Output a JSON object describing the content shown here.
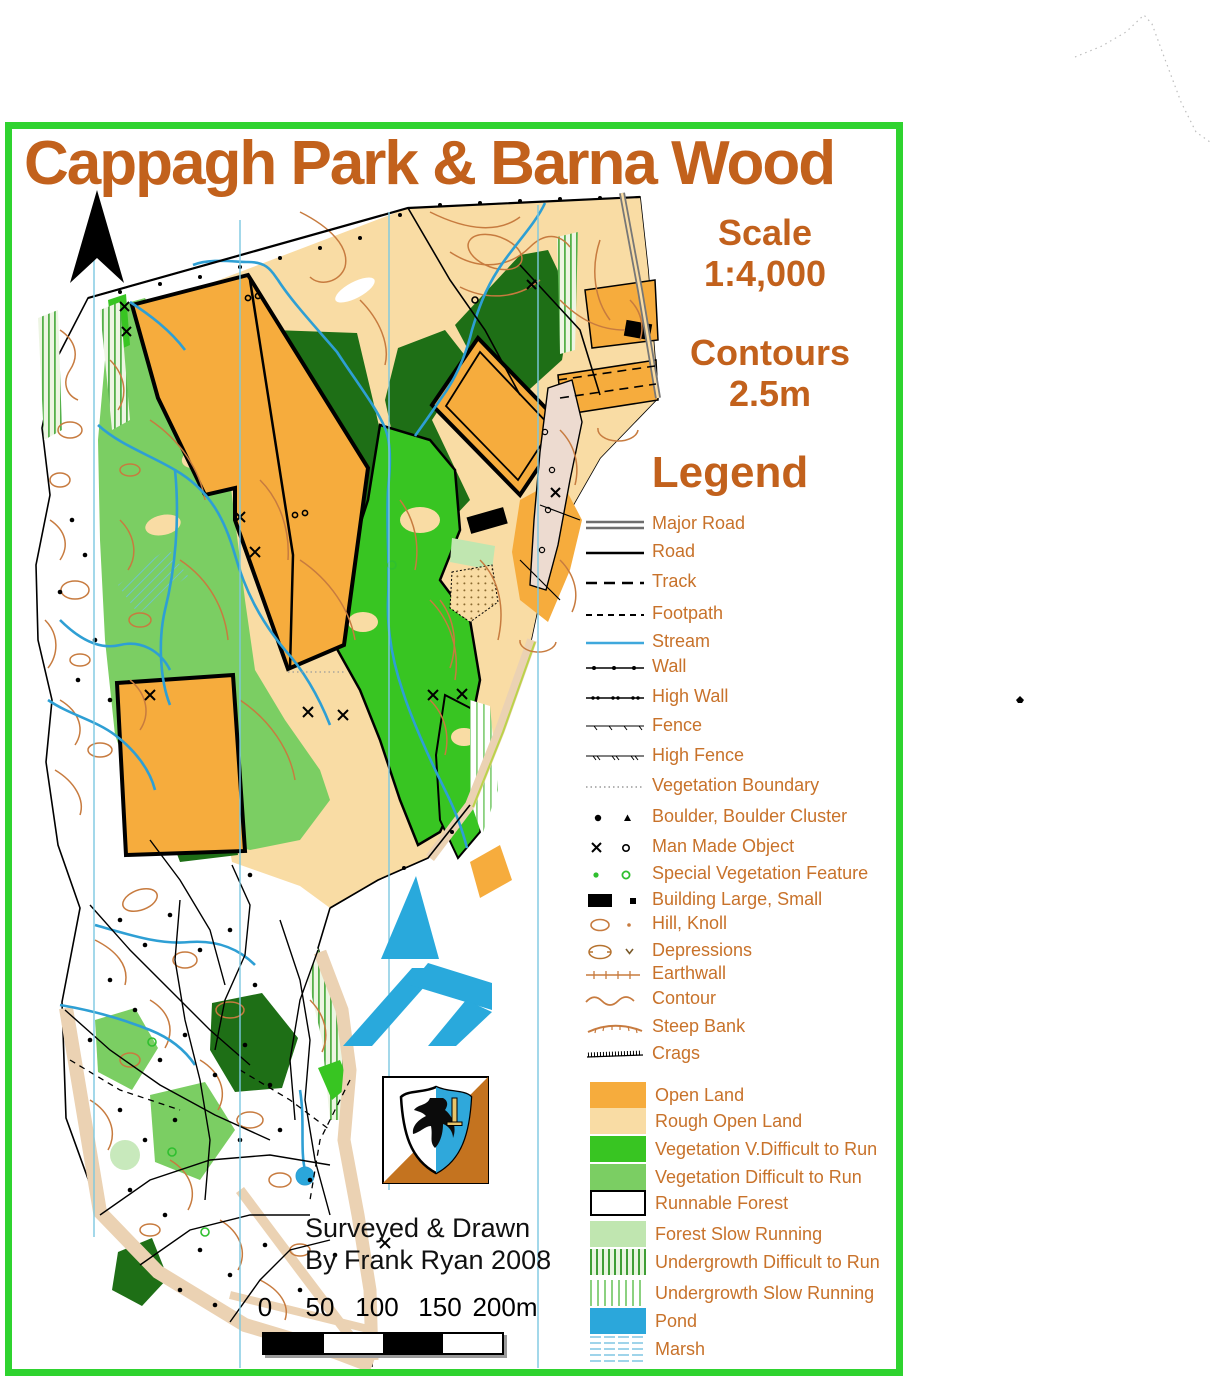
{
  "header": {
    "title": "Cappagh Park & Barna Wood"
  },
  "info": {
    "scale_label": "Scale",
    "scale_value": "1:4,000",
    "contours_label": "Contours",
    "contours_value": "2.5m"
  },
  "legend": {
    "title": "Legend",
    "line_items": [
      {
        "id": "major-road",
        "label": "Major Road"
      },
      {
        "id": "road",
        "label": "Road"
      },
      {
        "id": "track",
        "label": "Track"
      },
      {
        "id": "footpath",
        "label": "Footpath"
      },
      {
        "id": "stream",
        "label": "Stream"
      },
      {
        "id": "wall",
        "label": "Wall"
      },
      {
        "id": "high-wall",
        "label": "High Wall"
      },
      {
        "id": "fence",
        "label": "Fence"
      },
      {
        "id": "high-fence",
        "label": "High Fence"
      },
      {
        "id": "vegetation-boundary",
        "label": "Vegetation Boundary"
      },
      {
        "id": "boulder",
        "label": "Boulder, Boulder Cluster"
      },
      {
        "id": "man-made-object",
        "label": "Man Made Object"
      },
      {
        "id": "special-vegetation-feature",
        "label": "Special Vegetation Feature"
      },
      {
        "id": "building",
        "label": "Building Large, Small"
      },
      {
        "id": "hill-knoll",
        "label": "Hill, Knoll"
      },
      {
        "id": "depressions",
        "label": "Depressions"
      },
      {
        "id": "earthwall",
        "label": "Earthwall"
      },
      {
        "id": "contour",
        "label": "Contour"
      },
      {
        "id": "steep-bank",
        "label": "Steep Bank"
      },
      {
        "id": "crags",
        "label": "Crags"
      }
    ],
    "area_items": [
      {
        "id": "open-land",
        "label": "Open Land",
        "color": "#F6AC3D"
      },
      {
        "id": "rough-open-land",
        "label": "Rough Open Land",
        "color": "#F9DCA4"
      },
      {
        "id": "vegetation-v-difficult",
        "label": "Vegetation V.Difficult to Run",
        "color": "#38C522"
      },
      {
        "id": "vegetation-difficult",
        "label": "Vegetation Difficult to Run",
        "color": "#7BCE63"
      },
      {
        "id": "runnable-forest",
        "label": "Runnable Forest",
        "color": "#FFFFFF"
      },
      {
        "id": "forest-slow-running",
        "label": "Forest Slow Running",
        "color": "#C0E6B0"
      },
      {
        "id": "undergrowth-difficult",
        "label": "Undergrowth Difficult to Run",
        "color": "#3F9E36"
      },
      {
        "id": "undergrowth-slow",
        "label": "Undergrowth Slow Running",
        "color": "#8CD180"
      },
      {
        "id": "pond",
        "label": "Pond",
        "color": "#2BA7DB"
      },
      {
        "id": "marsh",
        "label": "Marsh",
        "color": "#9FD4EA"
      }
    ]
  },
  "credits": {
    "line1": "Surveyed & Drawn",
    "line2": "By Frank Ryan 2008"
  },
  "scale_bar": {
    "labels": [
      "0",
      "50",
      "100",
      "150",
      "200m"
    ]
  },
  "colors": {
    "frame_green": "#2FD32F",
    "title_brown": "#C2611C",
    "legend_text": "#C8722A",
    "contour_brown": "#C77B3F",
    "stream_blue": "#2E9FD4",
    "north_line_cyan": "#7CC8E0",
    "dark_forest_green": "#1E6F16",
    "road_beige": "#EBD2B3",
    "building_pink": "#EDDBD0",
    "logo_blue": "#29A9DC"
  }
}
